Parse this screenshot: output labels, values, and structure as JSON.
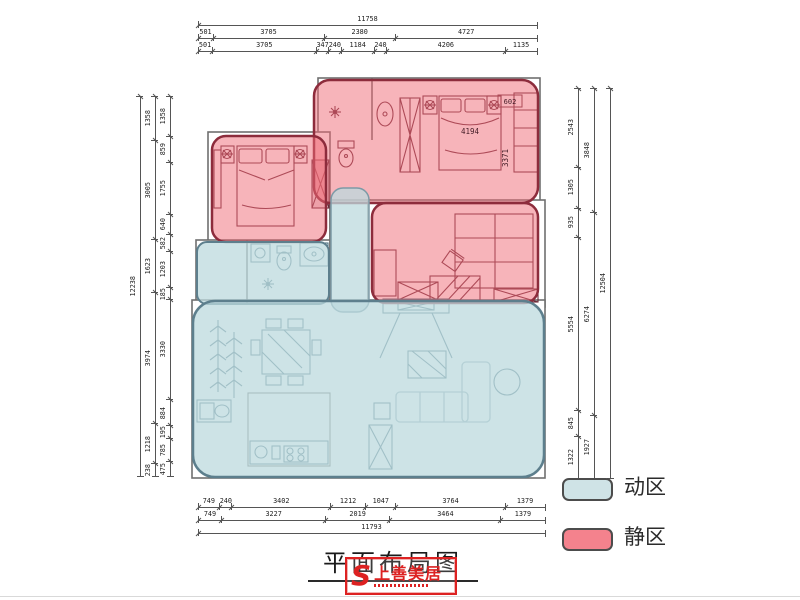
{
  "title": "平面布局图",
  "legend": {
    "items": [
      {
        "label": "动区",
        "color": "#cfe3e6"
      },
      {
        "label": "静区",
        "color": "#f4828d"
      }
    ]
  },
  "watermark": {
    "letter": "S",
    "text": "上善美居"
  },
  "plan_labels": {
    "bed_width": "4194",
    "room_depth": "3371",
    "corner": "602"
  },
  "colors": {
    "quiet_zone_fill": "#ef6a76",
    "quiet_zone_border": "#8d2c3c",
    "active_zone_fill": "#bcd9de",
    "active_zone_border": "#5d7f8d",
    "wall": "#6f6f6f",
    "dimension": "#555555",
    "stamp_red": "#dd2222"
  },
  "dims": {
    "top_total": [
      "11758"
    ],
    "top_row2": [
      "501",
      "3705",
      "2380",
      "4727"
    ],
    "top_row3": [
      "501",
      "3705",
      "347",
      "240",
      "1184",
      "240",
      "4206",
      "1135"
    ],
    "left_total": [
      "12238"
    ],
    "left_mid": [
      "1358",
      "3005",
      "1623",
      "3974",
      "1218",
      "238"
    ],
    "left_inner": [
      "1358",
      "859",
      "1755",
      "640",
      "582",
      "1203",
      "185",
      "3330",
      "884",
      "195",
      "785",
      "475"
    ],
    "right_inner": [
      "2543",
      "1305",
      "935",
      "5554",
      "845",
      "1322"
    ],
    "right_mid": [
      "3848",
      "6274",
      "1927"
    ],
    "right_total": [
      "12504"
    ],
    "bottom_row1": [
      "749",
      "240",
      "3402",
      "1212",
      "1047",
      "3764",
      "1379"
    ],
    "bottom_row2": [
      "749",
      "3227",
      "2019",
      "3464",
      "1379"
    ],
    "bottom_total": [
      "11793"
    ]
  }
}
